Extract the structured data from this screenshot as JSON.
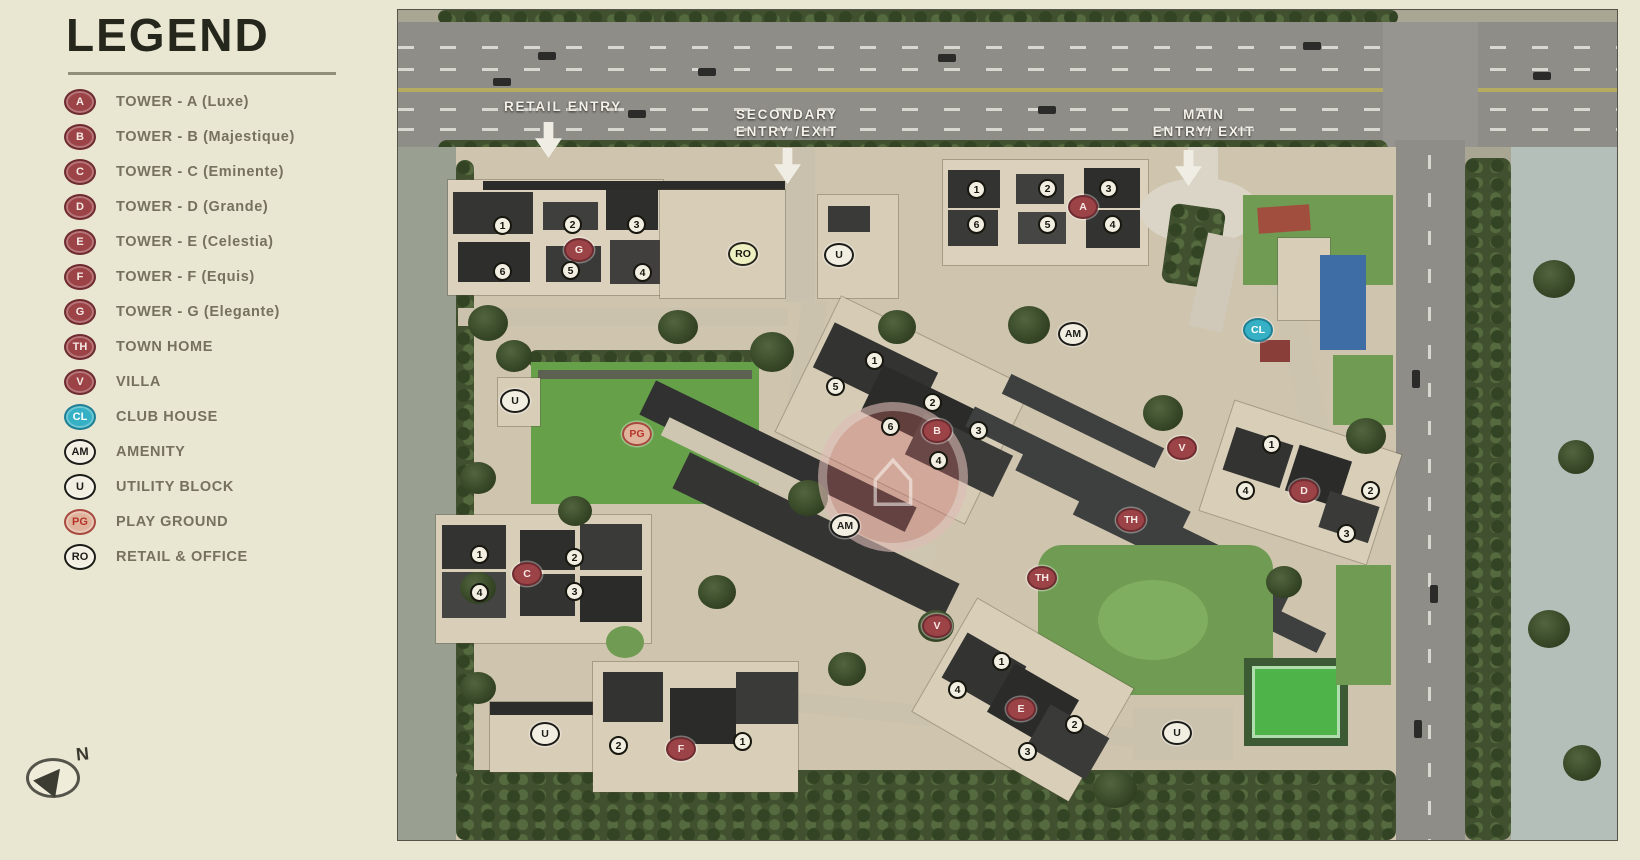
{
  "page": {
    "background": "#e9e7d2"
  },
  "legend": {
    "title": "LEGEND",
    "compass_label": "N",
    "items": [
      {
        "badge": "A",
        "type": "red",
        "label": "TOWER - A (Luxe)"
      },
      {
        "badge": "B",
        "type": "red",
        "label": "TOWER - B (Majestique)"
      },
      {
        "badge": "C",
        "type": "red",
        "label": "TOWER - C (Eminente)"
      },
      {
        "badge": "D",
        "type": "red",
        "label": "TOWER - D (Grande)"
      },
      {
        "badge": "E",
        "type": "red",
        "label": "TOWER - E (Celestia)"
      },
      {
        "badge": "F",
        "type": "red",
        "label": "TOWER - F (Equis)"
      },
      {
        "badge": "G",
        "type": "red",
        "label": "TOWER - G (Elegante)"
      },
      {
        "badge": "TH",
        "type": "red",
        "label": "TOWN HOME"
      },
      {
        "badge": "V",
        "type": "red",
        "label": "VILLA"
      },
      {
        "badge": "CL",
        "type": "teal",
        "label": "CLUB HOUSE"
      },
      {
        "badge": "AM",
        "type": "white",
        "label": "AMENITY"
      },
      {
        "badge": "U",
        "type": "white",
        "label": "UTILITY BLOCK"
      },
      {
        "badge": "PG",
        "type": "pink",
        "label": "PLAY GROUND"
      },
      {
        "badge": "RO",
        "type": "white",
        "label": "RETAIL & OFFICE"
      }
    ]
  },
  "map": {
    "watermark_glyph": "⌂",
    "badge_styles": {
      "red": {
        "bg": "#9c4347",
        "border": "#6e2c30",
        "text": "#f6e9e4"
      },
      "teal": {
        "bg": "#35b0c4",
        "border": "#1f7f95",
        "text": "#ffffff"
      },
      "white": {
        "bg": "#f2efe2",
        "border": "#1c1c18",
        "text": "#1c1c18"
      },
      "pink": {
        "bg": "#e0b49c",
        "border": "#a8493f",
        "text": "#b5342c"
      },
      "ro": {
        "bg": "#eef0c2",
        "border": "#26261c",
        "text": "#151510"
      }
    },
    "entry_points": [
      {
        "id": "retail-entry",
        "lines": [
          "RETAIL ENTRY"
        ],
        "x": 165,
        "y": 88,
        "arrow_x": 150,
        "arrow_y": 112
      },
      {
        "id": "secondary-entry",
        "lines": [
          "SECONDARY",
          "ENTRY /EXIT"
        ],
        "x": 389,
        "y": 96,
        "arrow_x": 389,
        "arrow_y": 138
      },
      {
        "id": "main-entry",
        "lines": [
          "MAIN",
          "ENTRY/ EXIT"
        ],
        "x": 806,
        "y": 96,
        "arrow_x": 790,
        "arrow_y": 140
      }
    ],
    "badges": [
      {
        "text": "G",
        "type": "red",
        "x": 181,
        "y": 240
      },
      {
        "text": "RO",
        "type": "ro",
        "x": 345,
        "y": 244
      },
      {
        "text": "U",
        "type": "white",
        "x": 441,
        "y": 245
      },
      {
        "text": "A",
        "type": "red",
        "x": 685,
        "y": 197
      },
      {
        "text": "AM",
        "type": "white",
        "x": 675,
        "y": 324
      },
      {
        "text": "CL",
        "type": "teal",
        "x": 860,
        "y": 320
      },
      {
        "text": "U",
        "type": "white",
        "x": 117,
        "y": 391
      },
      {
        "text": "PG",
        "type": "pink",
        "x": 239,
        "y": 424
      },
      {
        "text": "B",
        "type": "red",
        "x": 539,
        "y": 421
      },
      {
        "text": "AM",
        "type": "white",
        "x": 447,
        "y": 516
      },
      {
        "text": "V",
        "type": "red",
        "x": 784,
        "y": 438
      },
      {
        "text": "TH",
        "type": "red",
        "x": 733,
        "y": 510
      },
      {
        "text": "TH",
        "type": "red",
        "x": 644,
        "y": 568
      },
      {
        "text": "V",
        "type": "red",
        "x": 539,
        "y": 616
      },
      {
        "text": "D",
        "type": "red",
        "x": 906,
        "y": 481
      },
      {
        "text": "C",
        "type": "red",
        "x": 129,
        "y": 564
      },
      {
        "text": "U",
        "type": "white",
        "x": 147,
        "y": 724
      },
      {
        "text": "F",
        "type": "red",
        "x": 283,
        "y": 739
      },
      {
        "text": "E",
        "type": "red",
        "x": 623,
        "y": 699
      },
      {
        "text": "U",
        "type": "white",
        "x": 779,
        "y": 723
      }
    ],
    "unit_numbers": [
      {
        "text": "1",
        "x": 105,
        "y": 216
      },
      {
        "text": "2",
        "x": 175,
        "y": 215
      },
      {
        "text": "3",
        "x": 239,
        "y": 215
      },
      {
        "text": "6",
        "x": 105,
        "y": 262
      },
      {
        "text": "5",
        "x": 173,
        "y": 261
      },
      {
        "text": "4",
        "x": 245,
        "y": 263
      },
      {
        "text": "1",
        "x": 579,
        "y": 180
      },
      {
        "text": "2",
        "x": 650,
        "y": 179
      },
      {
        "text": "3",
        "x": 711,
        "y": 179
      },
      {
        "text": "6",
        "x": 579,
        "y": 215
      },
      {
        "text": "5",
        "x": 650,
        "y": 215
      },
      {
        "text": "4",
        "x": 715,
        "y": 215
      },
      {
        "text": "1",
        "x": 477,
        "y": 351
      },
      {
        "text": "5",
        "x": 438,
        "y": 377
      },
      {
        "text": "2",
        "x": 535,
        "y": 393
      },
      {
        "text": "6",
        "x": 493,
        "y": 417
      },
      {
        "text": "3",
        "x": 581,
        "y": 421
      },
      {
        "text": "4",
        "x": 541,
        "y": 451
      },
      {
        "text": "1",
        "x": 874,
        "y": 435
      },
      {
        "text": "4",
        "x": 848,
        "y": 481
      },
      {
        "text": "2",
        "x": 973,
        "y": 481
      },
      {
        "text": "3",
        "x": 949,
        "y": 524
      },
      {
        "text": "1",
        "x": 82,
        "y": 545
      },
      {
        "text": "2",
        "x": 177,
        "y": 548
      },
      {
        "text": "4",
        "x": 82,
        "y": 583
      },
      {
        "text": "3",
        "x": 177,
        "y": 582
      },
      {
        "text": "1",
        "x": 604,
        "y": 652
      },
      {
        "text": "4",
        "x": 560,
        "y": 680
      },
      {
        "text": "2",
        "x": 677,
        "y": 715
      },
      {
        "text": "3",
        "x": 630,
        "y": 742
      },
      {
        "text": "2",
        "x": 221,
        "y": 736
      },
      {
        "text": "1",
        "x": 345,
        "y": 732
      }
    ]
  }
}
